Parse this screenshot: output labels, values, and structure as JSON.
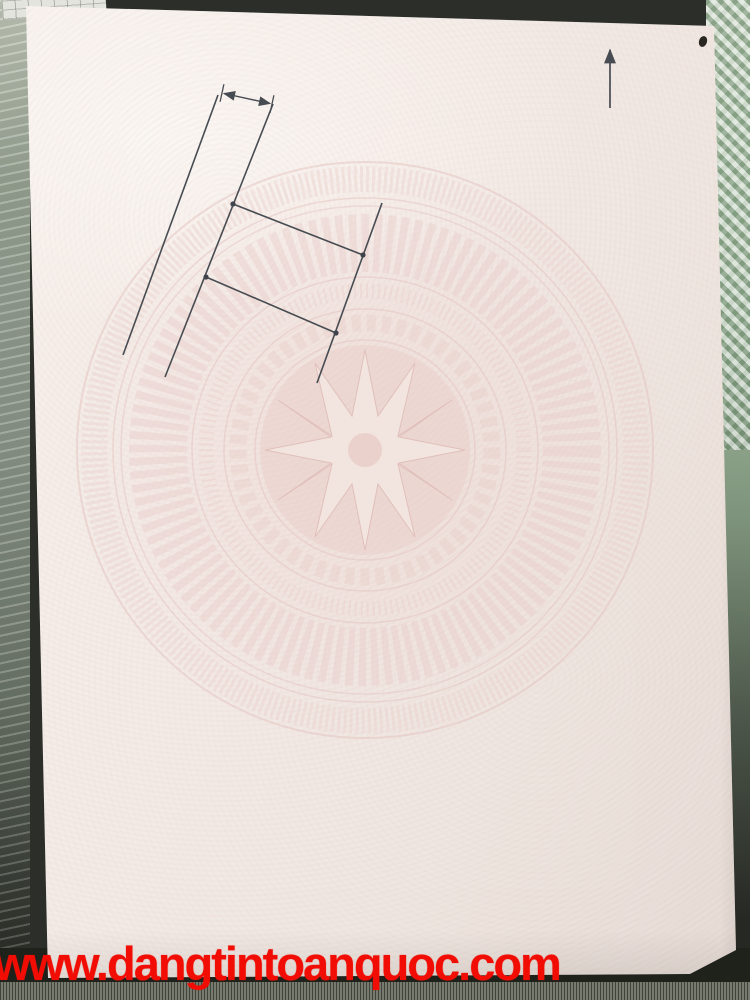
{
  "colors": {
    "ink": "#2b3240",
    "pattern_pink": "#e7c8c4",
    "accent_red": "#f20d04",
    "handwriting_blue": "#44678f"
  },
  "section4": {
    "title": "4. Sơ đồ thửa đất, tài sản gắn liền với đất:",
    "diagram": {
      "dimension_label": "4,0m",
      "north_label": "B",
      "road_label": "Ngõ xóm",
      "neighbor_top": "Cao Đức Hùng",
      "neighbor_bottom": "Cao Đức Hùng",
      "neighbor_right_line1": "Đất nông nghiệp",
      "neighbor_right_line2": "Hộ ông Hùng",
      "vertex1": "1",
      "vertex2": "2",
      "vertex3": "3",
      "vertex4": "4"
    },
    "vertex_table": {
      "header_col1_line1": "Số hiệu đỉnh",
      "header_col1_line2": "thửa",
      "header_col2_line1": "Chiều dài",
      "header_col2_line2": "(m)",
      "vertex_ids": [
        "1",
        "2",
        "3",
        "4",
        "1"
      ],
      "lengths": [
        "10,41",
        "5,75",
        "10,61",
        "5,70"
      ]
    }
  },
  "section5": {
    "title": "5. Ghi chú:",
    "note1": "- Số hiệu và diện tích thửa đất chưa được xác định theo bản đồ địa chính.",
    "note2": "- Thửa đất được tách từ thửa đất số 102, tờ bản đồ số 06."
  },
  "section6": {
    "title": "6. Những thay đổi sau khi cấp Giấy chứng nhận:",
    "col1_header": "Nội dung thay đổi và cơ sở pháp lý",
    "col2_header_line1": "Xác nhận của cơ quan",
    "col2_header_line2": "có thẩm quyền"
  },
  "footer": {
    "registry_label": "Số vào sổ cấp Giấy chứng nhận:",
    "registry_dots_lead": "....",
    "registry_prefix": "CN",
    "registry_number": "8538",
    "registry_dots_trail": "..............................",
    "notice_line1": "Người được cấp Giấy chứng nhận không được sửa chữa, tẩy xóa hoặc bổ sung bất kỳ nội dung nào trong",
    "notice_line2": "Giấy chứng nhận; khi bị mất hoặc hư hỏng Giấy chứng nhận phải khai báo ngay với cơ quan cấp Giấy.",
    "emboss_text": "Hùng"
  },
  "watermark": {
    "site": "www.dangtintoanquoc.com"
  }
}
